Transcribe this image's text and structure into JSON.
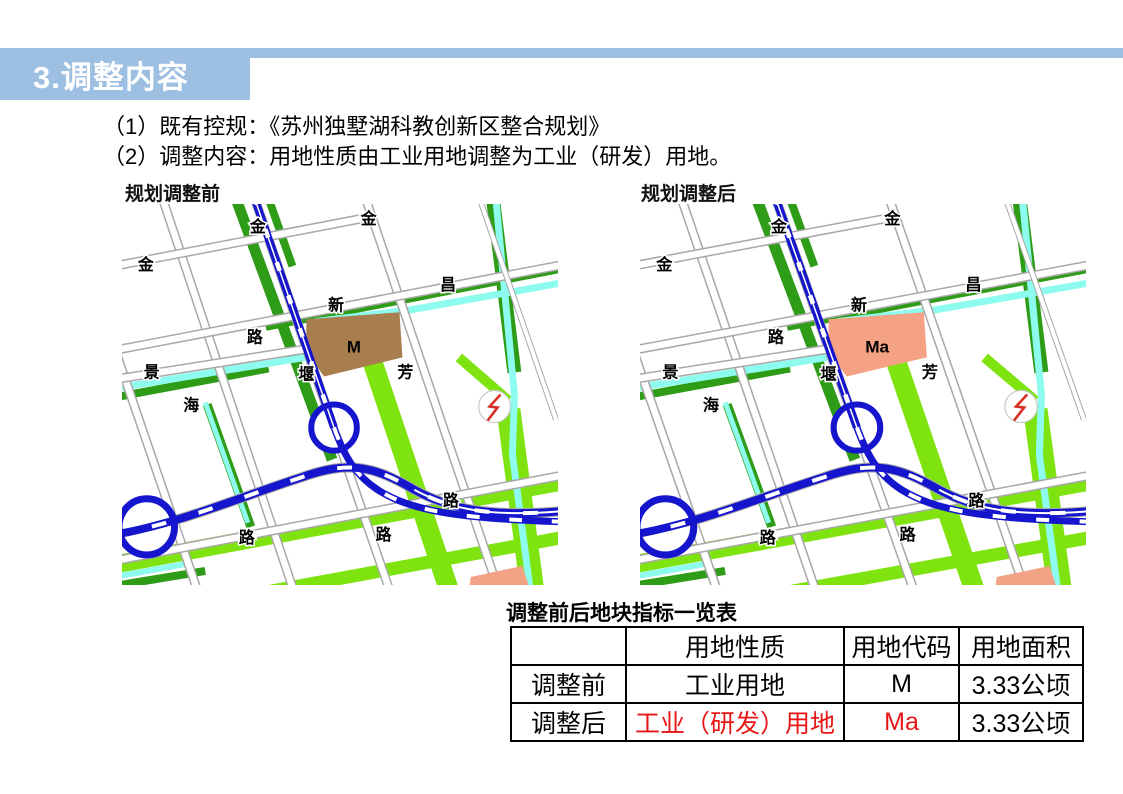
{
  "header": {
    "title": "3.调整内容",
    "bar_color": "#9CBFE2",
    "title_color": "#FFFFFF"
  },
  "intro": {
    "line1": "（1）既有控规：《苏州独墅湖科教创新区整合规划》",
    "line2": "（2）调整内容：用地性质由工业用地调整为工业（研发）用地。"
  },
  "maps": {
    "before": {
      "title": "规划调整前",
      "parcel_label": "M",
      "parcel_color": "#A87E4E"
    },
    "after": {
      "title": "规划调整后",
      "parcel_label": "Ma",
      "parcel_color": "#F5A184"
    },
    "street_labels": [
      "金",
      "金",
      "金",
      "昌",
      "新",
      "路",
      "堰",
      "芳",
      "景",
      "海",
      "路",
      "路",
      "路"
    ],
    "icons": [
      "substation-lightning-icon",
      "interchange-circle",
      "roundabout-circle"
    ],
    "colors": {
      "road_blue": "#1515CD",
      "dark_green": "#2E9C17",
      "bright_green": "#7FE30F",
      "canal_cyan": "#8DFBEE",
      "road_edge_gray": "#A8A8A8",
      "orange_patch": "#F2A285",
      "lightning_red": "#D93025"
    }
  },
  "table": {
    "title": "调整前后地块指标一览表",
    "headers": [
      "",
      "用地性质",
      "用地代码",
      "用地面积"
    ],
    "rows": [
      {
        "label": "调整前",
        "nature": "工业用地",
        "code": "M",
        "area": "3.33公顷",
        "highlight": false
      },
      {
        "label": "调整后",
        "nature": "工业（研发）用地",
        "code": "Ma",
        "area": "3.33公顷",
        "highlight": true
      }
    ],
    "highlight_color": "#E81515"
  }
}
